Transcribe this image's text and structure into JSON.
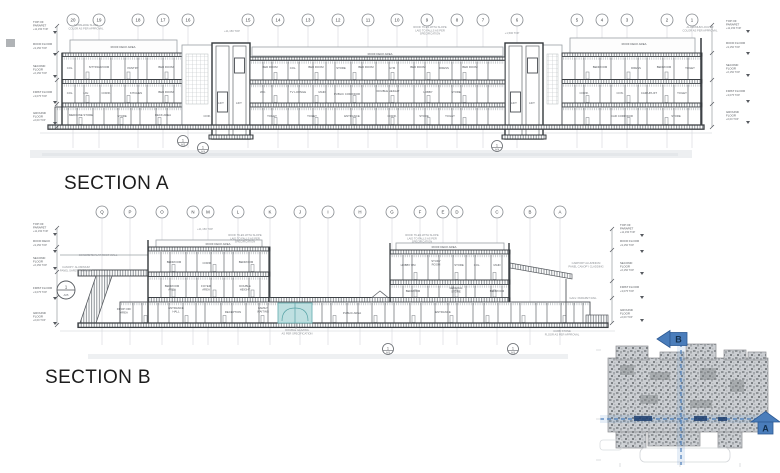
{
  "titles": {
    "section_a": "SECTION A",
    "section_b": "SECTION B"
  },
  "colors": {
    "accent_blue": "#4a7dbb",
    "navy_dash": "#1d3e6e",
    "teal_highlight": "#bfe0e1",
    "line_dark": "#3f4347",
    "line_light": "#d3d6da",
    "hatch_gray": "#8a8f94"
  },
  "key_plan": {
    "marker_a": "A",
    "marker_b": "B"
  },
  "section_a": {
    "grid_labels": [
      "20",
      "19",
      "18",
      "17",
      "16",
      "15",
      "14",
      "13",
      "12",
      "11",
      "10",
      "9",
      "8",
      "7",
      "6",
      "5",
      "4",
      "3",
      "2",
      "1"
    ],
    "grid_x": [
      73,
      99,
      138,
      163,
      188,
      248,
      278,
      308,
      338,
      368,
      397,
      427,
      457,
      483,
      517,
      577,
      602,
      627,
      667,
      692
    ],
    "levels_left": [
      {
        "label": "TOP OF\nPARAPET",
        "elev": "+11,150 TOP",
        "y": 23
      },
      {
        "label": "ROOF FLOOR",
        "elev": "+9,150 TOP",
        "y": 45
      },
      {
        "label": "SECOND\nFLOOR",
        "elev": "+6,150 TOP",
        "y": 67
      },
      {
        "label": "FIRST FLOOR",
        "elev": "+3,075 TOP",
        "y": 93
      },
      {
        "label": "GROUND\nFLOOR",
        "elev": "+0,00 TOP",
        "y": 114
      }
    ],
    "levels_right": [
      {
        "label": "TOP OF\nPARAPET",
        "elev": "+11,150 TOP",
        "y": 22
      },
      {
        "label": "ROOF FLOOR",
        "elev": "+9,150 TOP",
        "y": 44
      },
      {
        "label": "SECOND\nFLOOR",
        "elev": "+6,150 TOP",
        "y": 66
      },
      {
        "label": "FIRST FLOOR",
        "elev": "+3,075 TOP",
        "y": 92
      },
      {
        "label": "GROUND\nFLOOR",
        "elev": "+0,00 TOP",
        "y": 113
      }
    ],
    "notes": [
      {
        "t": "SUNSHADE SLATS\nCOLOR AS PER APPROVAL",
        "x": 86,
        "y": 26
      },
      {
        "t": "+11,150 TOP",
        "x": 232,
        "y": 32
      },
      {
        "t": "ROOF TILES WITH SLOPE\nLAID TO FALLS AS PER\nSPECIFICATION",
        "x": 430,
        "y": 28
      },
      {
        "t": "+1,500 TOP",
        "x": 512,
        "y": 34
      },
      {
        "t": "ALUMINIUM LOUVER\nCOLOR AS PER APPROVAL",
        "x": 700,
        "y": 28
      }
    ],
    "rooms": [
      {
        "t": "ROOF DECK AREA",
        "x": 123,
        "y": 48
      },
      {
        "t": "ROOF DECK AREA",
        "x": 380,
        "y": 55
      },
      {
        "t": "ROOF DECK AREA",
        "x": 634,
        "y": 45
      },
      {
        "t": "COL.",
        "x": 70,
        "y": 69
      },
      {
        "t": "SITTING ROOM",
        "x": 99,
        "y": 68
      },
      {
        "t": "PANTRY",
        "x": 133,
        "y": 69
      },
      {
        "t": "BED ROOM",
        "x": 166,
        "y": 68
      },
      {
        "t": "COL.",
        "x": 70,
        "y": 94
      },
      {
        "t": "LAV.",
        "x": 86,
        "y": 94
      },
      {
        "t": "CORR.",
        "x": 106,
        "y": 94
      },
      {
        "t": "KITCHEN",
        "x": 136,
        "y": 94
      },
      {
        "t": "BED ROOM",
        "x": 166,
        "y": 93
      },
      {
        "t": "MEDICINE STORE",
        "x": 81,
        "y": 116
      },
      {
        "t": "STORE",
        "x": 122,
        "y": 117
      },
      {
        "t": "DECK AREA",
        "x": 163,
        "y": 116
      },
      {
        "t": "COR.",
        "x": 207,
        "y": 117
      },
      {
        "t": "LIFT",
        "x": 221,
        "y": 104
      },
      {
        "t": "LIFT",
        "x": 239,
        "y": 104
      },
      {
        "t": "BED ROOM",
        "x": 270,
        "y": 68
      },
      {
        "t": "COL.",
        "x": 293,
        "y": 69
      },
      {
        "t": "BED ROOM",
        "x": 316,
        "y": 68
      },
      {
        "t": "STORE",
        "x": 341,
        "y": 69
      },
      {
        "t": "BED ROOM",
        "x": 366,
        "y": 68
      },
      {
        "t": "GYM",
        "x": 392,
        "y": 69
      },
      {
        "t": "BED ROOM",
        "x": 418,
        "y": 68
      },
      {
        "t": "DRESS",
        "x": 444,
        "y": 69
      },
      {
        "t": "BED ROOM",
        "x": 470,
        "y": 68
      },
      {
        "t": "W.C.",
        "x": 263,
        "y": 93
      },
      {
        "t": "TV LOUNGE",
        "x": 298,
        "y": 93
      },
      {
        "t": "MAID",
        "x": 322,
        "y": 93
      },
      {
        "t": "PUBLIC CORRIDOR",
        "x": 347,
        "y": 95
      },
      {
        "t": "DOUBLE HEIGHT",
        "x": 388,
        "y": 92
      },
      {
        "t": "LOBBY",
        "x": 428,
        "y": 93
      },
      {
        "t": "STORE",
        "x": 456,
        "y": 93
      },
      {
        "t": "TOILET",
        "x": 272,
        "y": 117
      },
      {
        "t": "TOILET",
        "x": 312,
        "y": 117
      },
      {
        "t": "ENTRANCE",
        "x": 352,
        "y": 117
      },
      {
        "t": "CORR.",
        "x": 392,
        "y": 117
      },
      {
        "t": "STORE",
        "x": 424,
        "y": 117
      },
      {
        "t": "TOILET",
        "x": 450,
        "y": 117
      },
      {
        "t": "LIFT",
        "x": 514,
        "y": 104
      },
      {
        "t": "LIFT",
        "x": 532,
        "y": 104
      },
      {
        "t": "BEDROOM",
        "x": 600,
        "y": 68
      },
      {
        "t": "DRESS",
        "x": 636,
        "y": 69
      },
      {
        "t": "BEDROOM",
        "x": 664,
        "y": 68
      },
      {
        "t": "TOILET",
        "x": 690,
        "y": 69
      },
      {
        "t": "CORR.",
        "x": 584,
        "y": 94
      },
      {
        "t": "CON.",
        "x": 620,
        "y": 94
      },
      {
        "t": "CAR UPLIFT",
        "x": 649,
        "y": 94
      },
      {
        "t": "TOILET",
        "x": 682,
        "y": 94
      },
      {
        "t": "CAR CORRIDOR",
        "x": 622,
        "y": 117
      },
      {
        "t": "STORE",
        "x": 676,
        "y": 117
      }
    ],
    "details": [
      {
        "n": "1",
        "s": "A05",
        "x": 183,
        "y": 141
      },
      {
        "n": "1",
        "s": "A04",
        "x": 203,
        "y": 148
      },
      {
        "n": "1",
        "s": "A04",
        "x": 497,
        "y": 146
      }
    ]
  },
  "section_b": {
    "grid_labels": [
      "Q",
      "P",
      "O",
      "N",
      "M",
      "L",
      "K",
      "J",
      "I",
      "H",
      "G",
      "F",
      "E",
      "D",
      "C",
      "B",
      "A"
    ],
    "grid_x": [
      102,
      130,
      162,
      193,
      208,
      238,
      270,
      300,
      328,
      360,
      392,
      420,
      443,
      457,
      497,
      530,
      560
    ],
    "levels_left": [
      {
        "label": "TOP OF\nPARAPET",
        "elev": "+11,150 TOP",
        "y": 225
      },
      {
        "label": "ROOF DECK",
        "elev": "+9,150 TOP",
        "y": 242
      },
      {
        "label": "SECOND\nFLOOR",
        "elev": "+6,150 TOP",
        "y": 259
      },
      {
        "label": "FIRST FLOOR",
        "elev": "+3,075 TOP",
        "y": 289
      },
      {
        "label": "GROUND\nFLOOR",
        "elev": "+0,00 TOP",
        "y": 314
      }
    ],
    "levels_right": [
      {
        "label": "TOP OF\nPARAPET",
        "elev": "+11,150 TOP",
        "y": 226
      },
      {
        "label": "ROOF FLOOR",
        "elev": "+9,150 TOP",
        "y": 242
      },
      {
        "label": "SECOND\nFLOOR",
        "elev": "+6,150 TOP",
        "y": 264
      },
      {
        "label": "FIRST FLOOR",
        "elev": "+3,075 TOP",
        "y": 288
      },
      {
        "label": "GROUND\nFLOOR",
        "elev": "+0,00 TOP",
        "y": 311
      }
    ],
    "notes": [
      {
        "t": "+11,150 TOP",
        "x": 205,
        "y": 230
      },
      {
        "t": "ROOF TILES WITH SLOPE\nLAID TO FALLS AS PER\nSPECIFICATION",
        "x": 245,
        "y": 236
      },
      {
        "t": "ROOF TILES WITH SLOPE\nLAID TO FALLS AS PER\nSPECIFICATION",
        "x": 422,
        "y": 236
      },
      {
        "t": "CONCRETE FLAT ROOF WALL",
        "x": 98,
        "y": 256
      },
      {
        "t": "CANOPY: ALUMINIUM\nPANEL SAFETY GLAZING",
        "x": 76,
        "y": 268
      },
      {
        "t": "CARPORT ALUMINIUM\nPANEL CANOPY CLADDING",
        "x": 586,
        "y": 264
      },
      {
        "t": "GALV. PARAPET RAIL",
        "x": 583,
        "y": 299
      },
      {
        "t": "DOUBLE GLAZING\nAS PER SPECIFICATION",
        "x": 297,
        "y": 331
      },
      {
        "t": "CURB STONE\nFLOOR AS PER APPROVAL",
        "x": 562,
        "y": 332
      }
    ],
    "rooms": [
      {
        "t": "ROOF DECK AREA",
        "x": 218,
        "y": 245
      },
      {
        "t": "ROOF DECK AREA",
        "x": 444,
        "y": 248
      },
      {
        "t": "BEDROOM",
        "x": 174,
        "y": 263
      },
      {
        "t": "CORR.",
        "x": 207,
        "y": 264
      },
      {
        "t": "BEDROOM",
        "x": 246,
        "y": 263
      },
      {
        "t": "BEDROOM\nAREA",
        "x": 172,
        "y": 287
      },
      {
        "t": "FOYER\nAREA",
        "x": 206,
        "y": 287
      },
      {
        "t": "DOUBLE\nHEIGHT",
        "x": 245,
        "y": 287
      },
      {
        "t": "ENTRANCE\nHALL",
        "x": 176,
        "y": 309
      },
      {
        "t": "RECEPTION",
        "x": 233,
        "y": 313
      },
      {
        "t": "FAMILY\nWAITING",
        "x": 263,
        "y": 309
      },
      {
        "t": "PUBLIC AREA",
        "x": 352,
        "y": 314
      },
      {
        "t": "HOBBY RM",
        "x": 408,
        "y": 266
      },
      {
        "t": "STUDY\nROOM",
        "x": 436,
        "y": 262
      },
      {
        "t": "STORE",
        "x": 459,
        "y": 266
      },
      {
        "t": "COL.",
        "x": 477,
        "y": 266
      },
      {
        "t": "MAID",
        "x": 497,
        "y": 266
      },
      {
        "t": "BEDROOM",
        "x": 413,
        "y": 292
      },
      {
        "t": "GENERAL\nSTORE",
        "x": 456,
        "y": 289
      },
      {
        "t": "BEDROOM",
        "x": 497,
        "y": 292
      },
      {
        "t": "ENTRANCE",
        "x": 443,
        "y": 313
      },
      {
        "t": "DROP OFF\nAREA",
        "x": 124,
        "y": 310
      }
    ],
    "details": [
      {
        "n": "1",
        "s": "A06",
        "x": 388,
        "y": 349
      },
      {
        "n": "1",
        "s": "A06",
        "x": 513,
        "y": 349
      }
    ],
    "detail_big": {
      "n": "1",
      "s": "A05",
      "x": 66,
      "y": 290
    }
  }
}
